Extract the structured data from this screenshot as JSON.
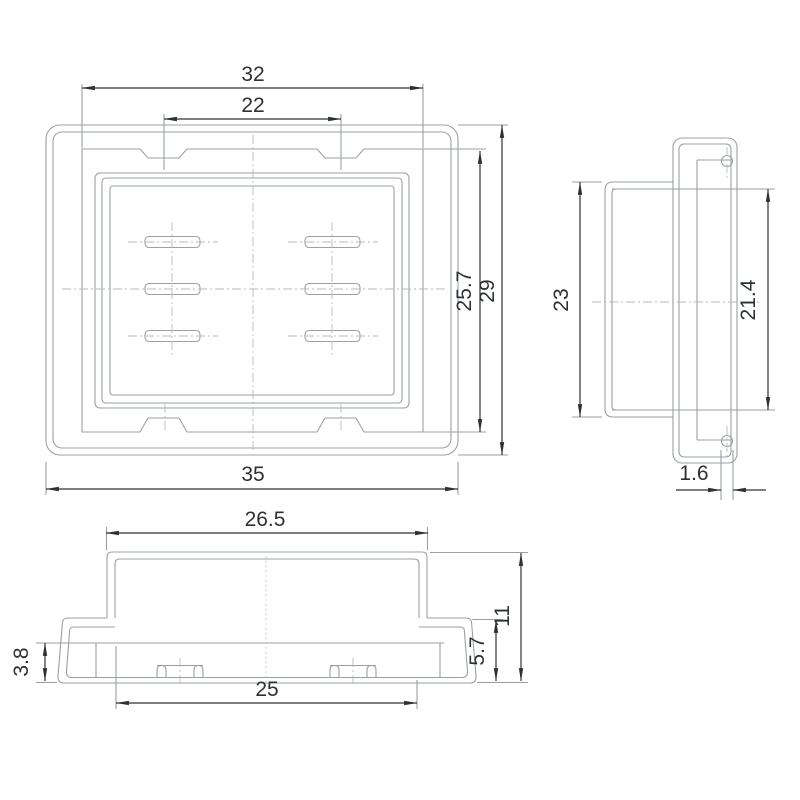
{
  "colors": {
    "background": "#ffffff",
    "outline_gray": "#9ba0a3",
    "centerline_gray": "#b5babd",
    "dimension_black": "#2e3133"
  },
  "views": {
    "front": {
      "label": "front-view",
      "dims": {
        "body_width": "32",
        "notch_spacing": "22",
        "inner_height": "25.7",
        "flange_height": "29",
        "flange_width": "35"
      }
    },
    "side": {
      "label": "side-view",
      "dims": {
        "body_height": "23",
        "opening_height": "21.4",
        "flange_thickness": "1.6"
      }
    },
    "bottom": {
      "label": "bottom-view",
      "dims": {
        "body_width": "26.5",
        "total_height": "11",
        "skirt_height": "5.7",
        "lip_height": "3.8",
        "opening_width": "25"
      }
    }
  }
}
